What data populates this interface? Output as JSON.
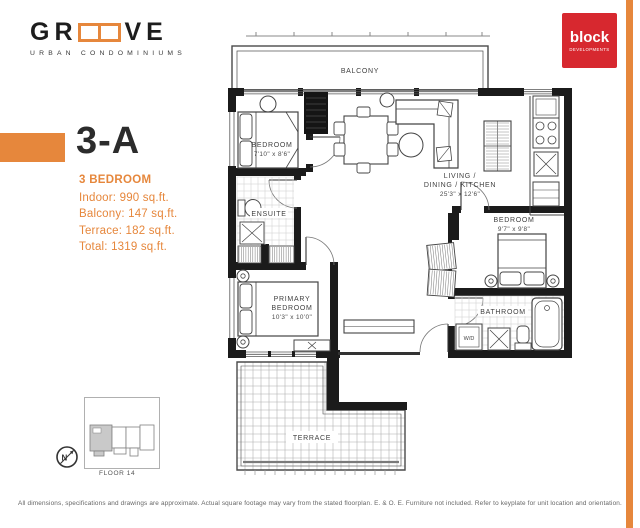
{
  "brand": {
    "logo_left": "GR",
    "logo_right": "VE",
    "logo_sub": "URBAN CONDOMINIUMS",
    "developer_name": "block",
    "developer_sub": "DEVELOPMENTS"
  },
  "unit": {
    "name": "3-A",
    "type": "3 BEDROOM",
    "stats": [
      "Indoor: 990 sq.ft.",
      "Balcony: 147 sq.ft.",
      "Terrace: 182 sq.ft.",
      "Total: 1319 sq.ft."
    ]
  },
  "floorplan": {
    "balcony": "BALCONY",
    "terrace": "TERRACE",
    "bedroom1": {
      "name": "BEDROOM",
      "dims": "7'10\" x 8'6\""
    },
    "living": {
      "line1": "LIVING /",
      "line2": "DINING / KITCHEN",
      "dims": "25'3\" x 12'6\""
    },
    "ensuite": {
      "name": "ENSUITE"
    },
    "bedroom2": {
      "name": "BEDROOM",
      "dims": "9'7\" x 9'8\""
    },
    "primary": {
      "line1": "PRIMARY",
      "line2": "BEDROOM",
      "dims": "10'3\" x 10'0\""
    },
    "bathroom": {
      "name": "BATHROOM"
    },
    "washer_dryer": "W/D"
  },
  "keyplate": {
    "floor": "FLOOR 14",
    "north": "N"
  },
  "footer": {
    "disclaimer": "All dimensions, specifications and drawings are approximate. Actual square footage may vary from the stated floorplan. E. & O. E. Furniture not included. Refer to keyplate for unit location and orientation."
  },
  "colors": {
    "accent": "#E6873C",
    "developer_red": "#D7282F",
    "wall": "#1B1B1B"
  }
}
